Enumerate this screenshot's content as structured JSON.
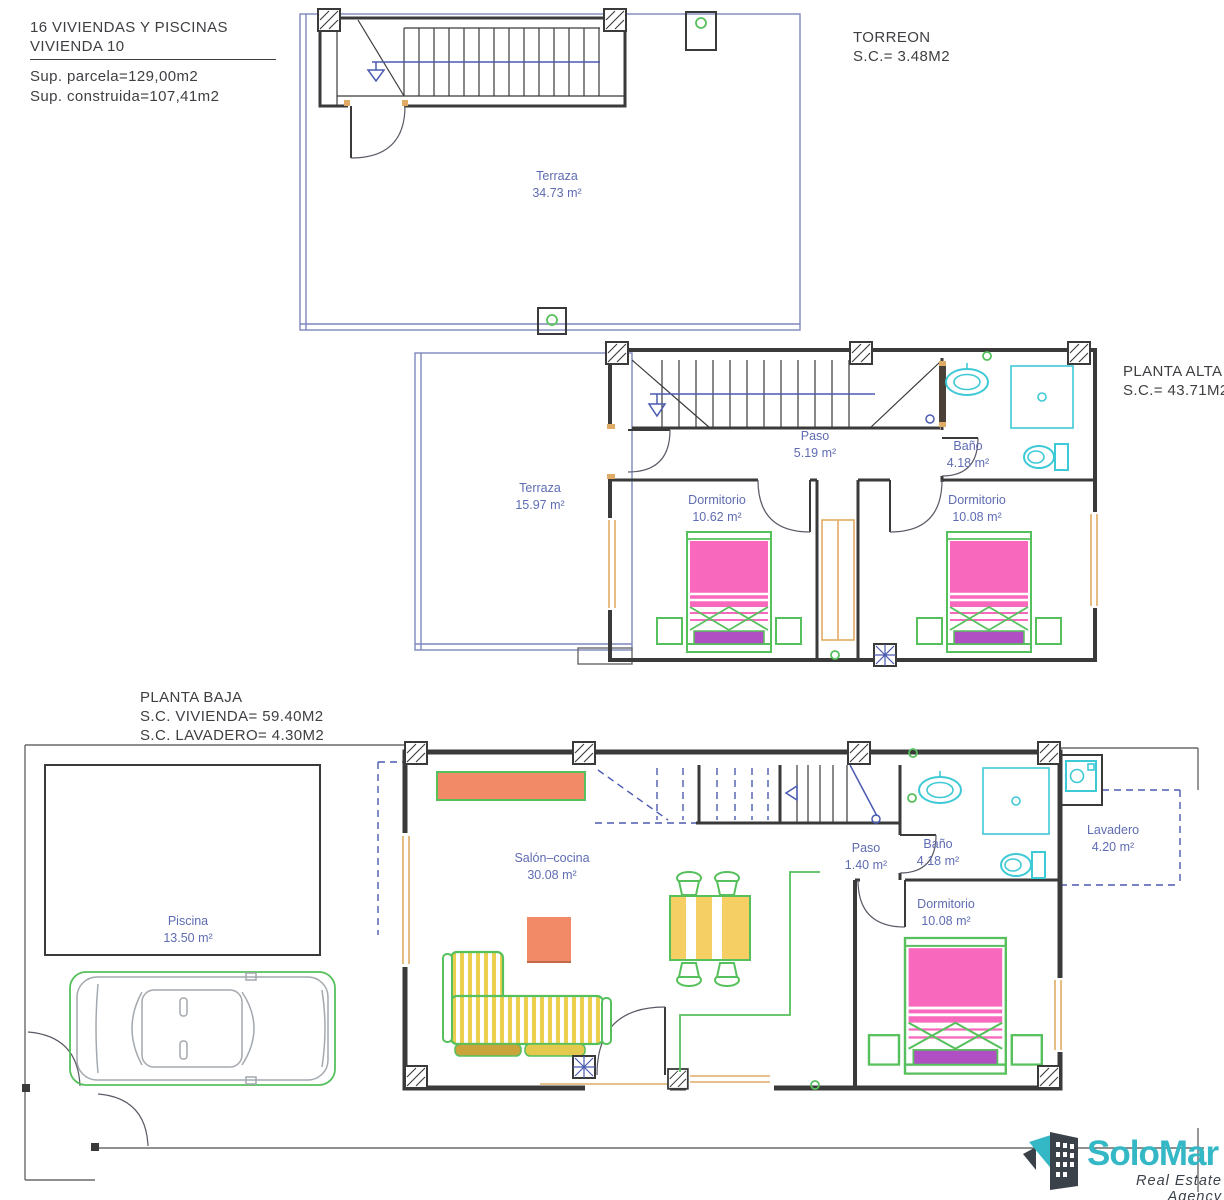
{
  "title_block": {
    "project": "16 VIVIENDAS Y PISCINAS",
    "unit": "VIVIENDA 10",
    "plot_area": "Sup. parcela=129,00m2",
    "built_area": "Sup. construida=107,41m2"
  },
  "plan_labels": {
    "torreon": {
      "title": "TORREON",
      "area": "S.C.=  3.48M2"
    },
    "planta_alta": {
      "title": "PLANTA ALTA",
      "area": "S.C.=  43.71M2"
    },
    "planta_baja": {
      "title": "PLANTA BAJA",
      "area_vivienda": "S.C. VIVIENDA=  59.40M2",
      "area_lavadero": "S.C. LAVADERO=  4.30M2"
    }
  },
  "rooms": {
    "terraza_torreon": {
      "name": "Terraza",
      "area": "34.73 m²"
    },
    "paso_alta": {
      "name": "Paso",
      "area": "5.19 m²"
    },
    "bano_alta": {
      "name": "Baño",
      "area": "4.18 m²"
    },
    "terraza_alta": {
      "name": "Terraza",
      "area": "15.97 m²"
    },
    "dormitorio_alta_izq": {
      "name": "Dormitorio",
      "area": "10.62 m²"
    },
    "dormitorio_alta_der": {
      "name": "Dormitorio",
      "area": "10.08 m²"
    },
    "salon_cocina": {
      "name": "Salón–cocina",
      "area": "30.08 m²"
    },
    "paso_baja": {
      "name": "Paso",
      "area": "1.40 m²"
    },
    "bano_baja": {
      "name": "Baño",
      "area": "4.18 m²"
    },
    "lavadero": {
      "name": "Lavadero",
      "area": "4.20 m²"
    },
    "dormitorio_baja": {
      "name": "Dormitorio",
      "area": "10.08 m²"
    },
    "piscina": {
      "name": "Piscina",
      "area": "13.50 m²"
    }
  },
  "logo": {
    "brand": "SoloMar",
    "tagline": "Real Estate Agency"
  },
  "colors": {
    "wall": "#3a3a3a",
    "line_blue": "#4a5ab0",
    "terrace_blue": "#7d87bd",
    "label_blue": "#5f6cb2",
    "cyan": "#3ec9d6",
    "green": "#56c05c",
    "pink": "#f869bd",
    "purple": "#b04fc4",
    "salmon": "#f28a68",
    "yellow": "#eed04f",
    "door_orange": "#e0ab64",
    "logo_teal": "#35b8c6",
    "logo_dark": "#3a4149"
  }
}
